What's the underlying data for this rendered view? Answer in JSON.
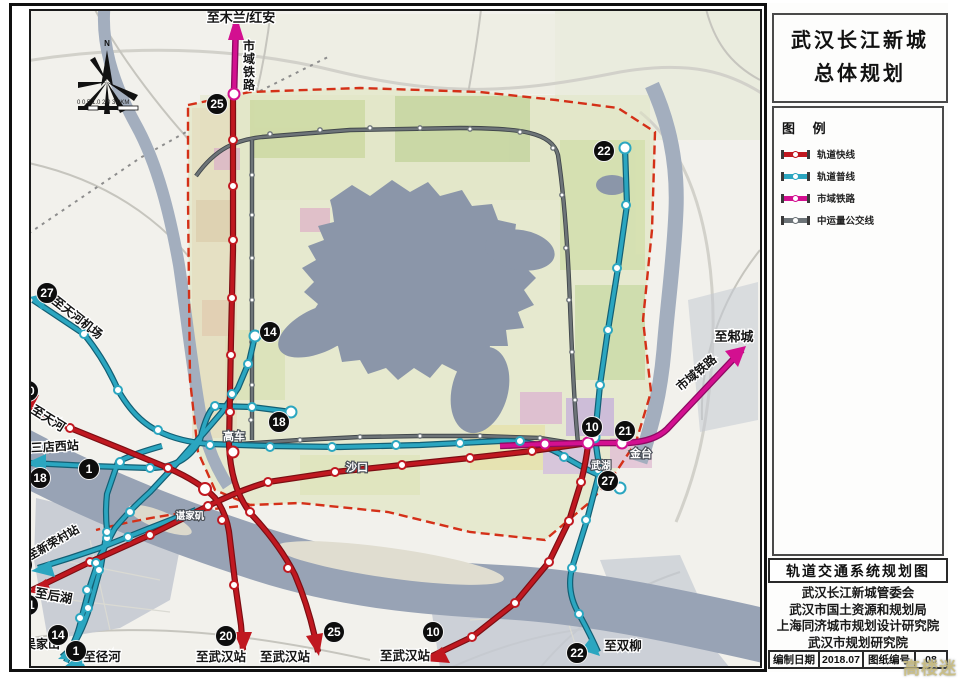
{
  "panel": {
    "title_line1": "武汉长江新城",
    "title_line2": "总体规划",
    "legend_title": "图 例",
    "legend_items": [
      {
        "label": "轨道快线",
        "key": "express"
      },
      {
        "label": "轨道普线",
        "key": "local"
      },
      {
        "label": "市域铁路",
        "key": "regional"
      },
      {
        "label": "中运量公交线",
        "key": "brt"
      }
    ],
    "map_title": "轨道交通系统规划图",
    "credits": [
      "武汉长江新城管委会",
      "武汉市国土资源和规划局",
      "上海同济城市规划设计研究院",
      "武汉市规划研究院"
    ],
    "footer": {
      "date_label": "编制日期",
      "date_value": "2018.07",
      "sheet_label": "图纸编号",
      "sheet_value": "08"
    }
  },
  "colors": {
    "express": "#c01820",
    "local": "#2ba6c0",
    "regional": "#d31090",
    "brt": "#6d7478",
    "boundary": "#d43018"
  },
  "map": {
    "compass_label": "N",
    "scale_text": "0 0.5 1.0   2.0   3.0KM",
    "watermark": "高楼迷",
    "place_labels": [
      {
        "text": "高车",
        "x": 234,
        "y": 440,
        "size": 11
      },
      {
        "text": "沙口",
        "x": 357,
        "y": 471,
        "size": 11
      },
      {
        "text": "谌家矶",
        "x": 190,
        "y": 519,
        "size": 9.5
      },
      {
        "text": "金台",
        "x": 641,
        "y": 457,
        "size": 11
      },
      {
        "text": "武湖",
        "x": 601,
        "y": 469,
        "size": 10
      }
    ],
    "direction_labels": [
      {
        "text": "至木兰/红安",
        "x": 241,
        "y": 22,
        "r": 0,
        "size": 13
      },
      {
        "text": "市域铁路",
        "x": 249,
        "y": 50,
        "vertical": true,
        "size": 12
      },
      {
        "text": "至邾城",
        "x": 734,
        "y": 341,
        "r": 0,
        "size": 13
      },
      {
        "text": "市域铁路",
        "x": 699,
        "y": 376,
        "r": -40,
        "size": 12
      },
      {
        "text": "至天河机场",
        "x": 75,
        "y": 321,
        "r": 38,
        "size": 12
      },
      {
        "text": "至天河",
        "x": 46,
        "y": 422,
        "r": 32,
        "size": 12.5
      },
      {
        "text": "至三店西站",
        "x": 49,
        "y": 451,
        "r": -3,
        "size": 12
      },
      {
        "text": "至新荣村站",
        "x": 55,
        "y": 546,
        "r": -30,
        "size": 11.5
      },
      {
        "text": "至后湖",
        "x": 53,
        "y": 600,
        "r": 10,
        "size": 12.5
      },
      {
        "text": "至吴家山",
        "x": 36,
        "y": 648,
        "r": 0,
        "size": 12
      },
      {
        "text": "至径河",
        "x": 102,
        "y": 661,
        "r": 0,
        "size": 12.5
      },
      {
        "text": "至武汉站",
        "x": 221,
        "y": 661,
        "r": 0,
        "size": 12.5
      },
      {
        "text": "至武汉站",
        "x": 285,
        "y": 661,
        "r": 0,
        "size": 12.5
      },
      {
        "text": "至武汉站",
        "x": 405,
        "y": 660,
        "r": 0,
        "size": 12.5
      },
      {
        "text": "至双柳",
        "x": 623,
        "y": 650,
        "r": 0,
        "size": 12.5
      }
    ],
    "badges": [
      {
        "n": "25",
        "x": 217,
        "y": 104
      },
      {
        "n": "22",
        "x": 604,
        "y": 151
      },
      {
        "n": "14",
        "x": 270,
        "y": 332
      },
      {
        "n": "27",
        "x": 47,
        "y": 293
      },
      {
        "n": "20",
        "x": 28,
        "y": 391
      },
      {
        "n": "18",
        "x": 279,
        "y": 422
      },
      {
        "n": "18",
        "x": 40,
        "y": 478
      },
      {
        "n": "1",
        "x": 89,
        "y": 469
      },
      {
        "n": "23",
        "x": 22,
        "y": 565
      },
      {
        "n": "21",
        "x": 28,
        "y": 605
      },
      {
        "n": "14",
        "x": 58,
        "y": 635
      },
      {
        "n": "1",
        "x": 76,
        "y": 651
      },
      {
        "n": "20",
        "x": 226,
        "y": 636
      },
      {
        "n": "25",
        "x": 334,
        "y": 632
      },
      {
        "n": "10",
        "x": 433,
        "y": 632
      },
      {
        "n": "22",
        "x": 577,
        "y": 653
      },
      {
        "n": "10",
        "x": 592,
        "y": 427
      },
      {
        "n": "21",
        "x": 625,
        "y": 431
      },
      {
        "n": "27",
        "x": 608,
        "y": 481
      }
    ]
  }
}
